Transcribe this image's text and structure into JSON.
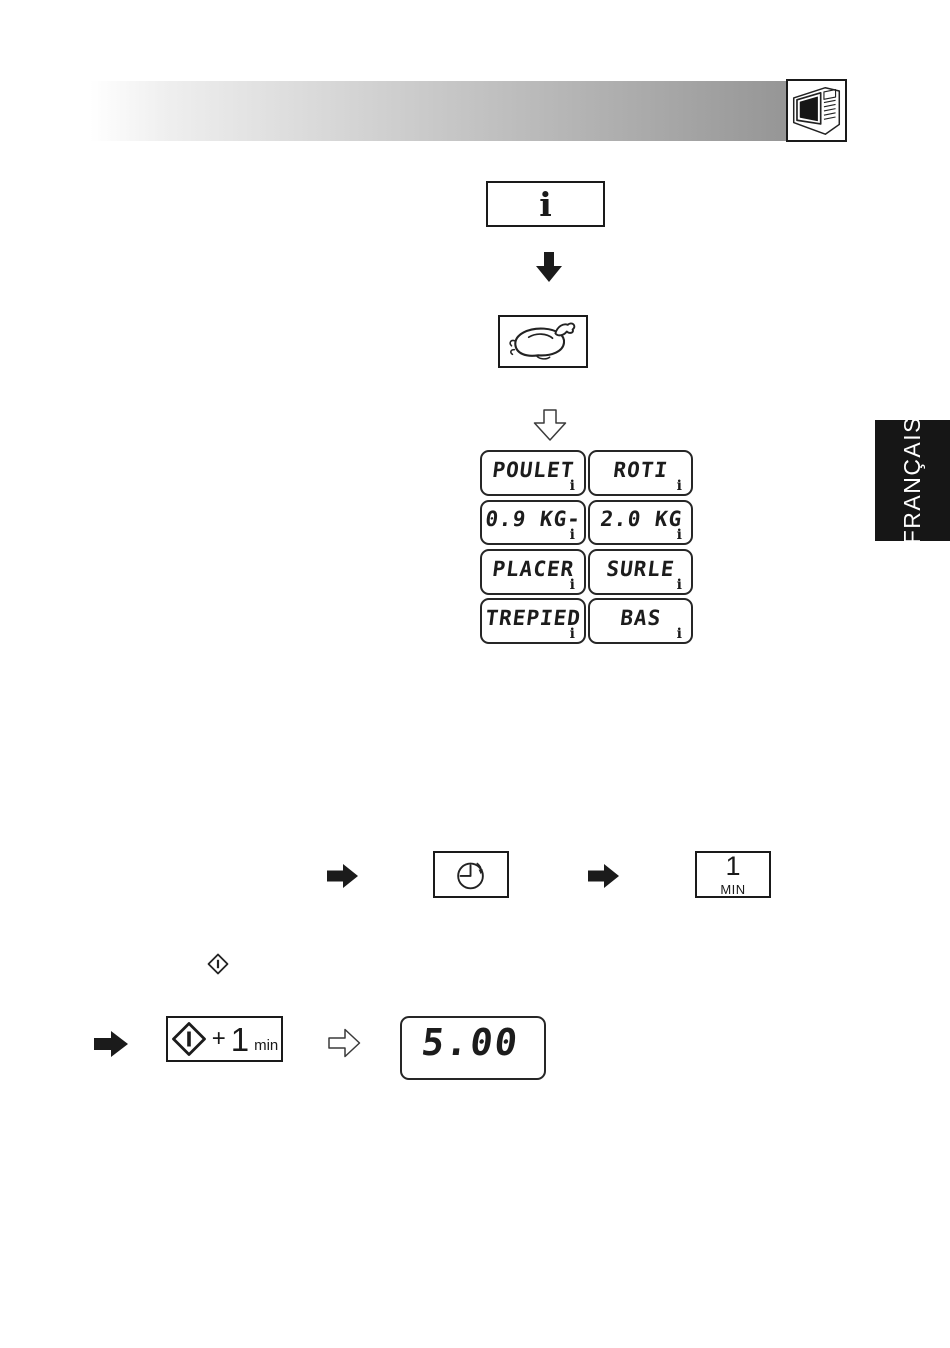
{
  "header": {
    "gradient_start": "#ffffff",
    "gradient_end": "#8d8d8d"
  },
  "info_button": {
    "label": "i"
  },
  "lcd_grid": {
    "cells": [
      {
        "text": "POULET",
        "badge": "i"
      },
      {
        "text": "ROTI",
        "badge": "i"
      },
      {
        "text": "0.9 KG-",
        "badge": "i"
      },
      {
        "text": "2.0 KG",
        "badge": "i"
      },
      {
        "text": "PLACER",
        "badge": "i"
      },
      {
        "text": "SURLE",
        "badge": "i"
      },
      {
        "text": "TREPIED",
        "badge": "i"
      },
      {
        "text": "BAS",
        "badge": "i"
      }
    ]
  },
  "language_tab": {
    "label": "FRANÇAIS"
  },
  "timer_row": {
    "one_min_value": "1",
    "one_min_unit": "MIN"
  },
  "start_row": {
    "plus": "+",
    "amount": "1",
    "unit": "min"
  },
  "time_display": {
    "value": "5.00"
  }
}
